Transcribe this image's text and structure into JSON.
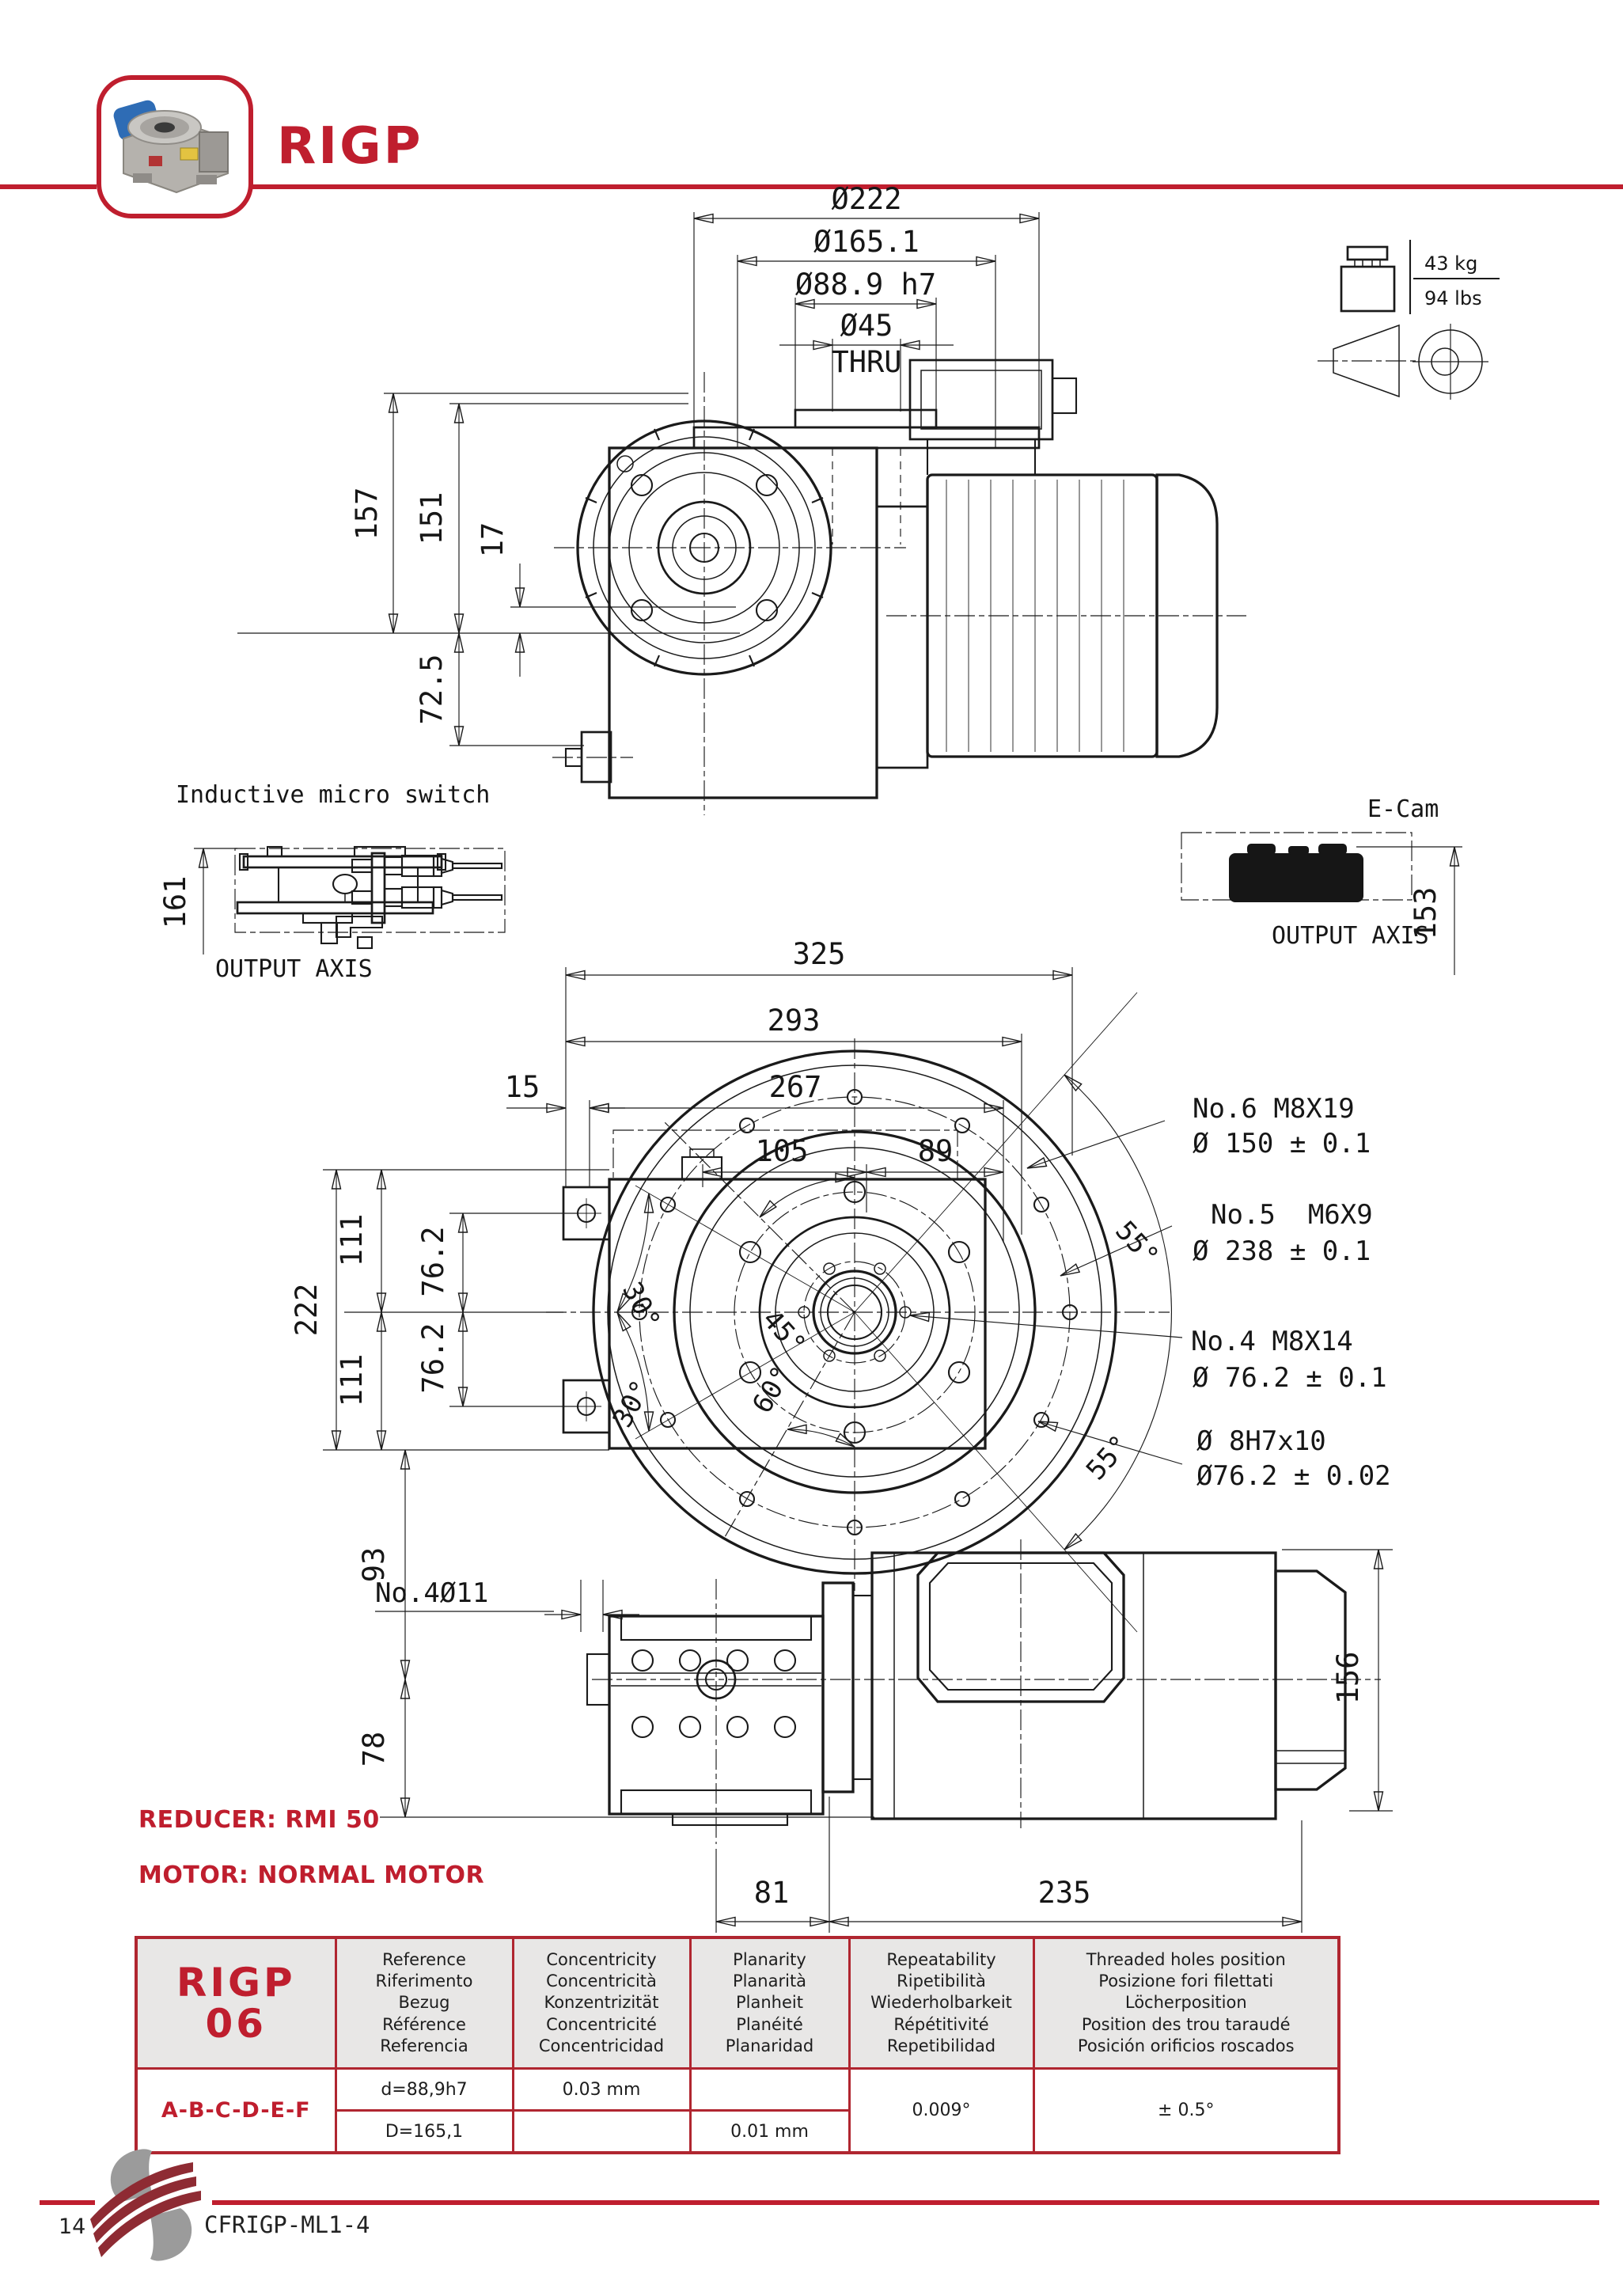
{
  "header": {
    "title": "RIGP"
  },
  "weight_badge": {
    "kg": "43 kg",
    "lbs": "94 lbs"
  },
  "top_view": {
    "dia222": "Ø222",
    "dia165": "Ø165.1",
    "dia889": "Ø88.9 h7",
    "dia45": "Ø45",
    "thru": "THRU",
    "d157": "157",
    "d151": "151",
    "d17": "17",
    "d725": "72.5"
  },
  "micro_switch": {
    "title": "Inductive micro switch",
    "d161": "161",
    "axis": "OUTPUT AXIS"
  },
  "ecam": {
    "title": "E-Cam",
    "d153": "153",
    "axis": "OUTPUT AXIS"
  },
  "front_view": {
    "d325": "325",
    "d293": "293",
    "d267": "267",
    "d15": "15",
    "d105": "105",
    "d89": "89",
    "d222": "222",
    "d111a": "111",
    "d111b": "111",
    "d762a": "76.2",
    "d762b": "76.2",
    "d93": "93",
    "d78": "78",
    "d81": "81",
    "d235": "235",
    "d156": "156",
    "no4d11": "No.4Ø11",
    "a55t": "55°",
    "a55b": "55°",
    "a30t": "30°",
    "a30b": "30°",
    "a45": "45°",
    "a60": "60°",
    "ann": [
      [
        "No.6 M8X19",
        "Ø 150 ± 0.1"
      ],
      [
        "No.5  M6X9",
        "Ø 238 ± 0.1"
      ],
      [
        "No.4 M8X14",
        "Ø 76.2 ± 0.1"
      ],
      [
        "Ø 8H7x10",
        "Ø76.2 ± 0.02"
      ]
    ]
  },
  "notes": {
    "reducer": "REDUCER: RMI 50",
    "motor": "MOTOR: NORMAL MOTOR"
  },
  "table": {
    "model_line1": "RIGP",
    "model_line2": "06",
    "row_label": "A-B-C-D-E-F",
    "headers": {
      "reference": [
        "Reference",
        "Riferimento",
        "Bezug",
        "Référence",
        "Referencia"
      ],
      "concentricity": [
        "Concentricity",
        "Concentricità",
        "Konzentrizität",
        "Concentricité",
        "Concentricidad"
      ],
      "planarity": [
        "Planarity",
        "Planarità",
        "Planheit",
        "Planéité",
        "Planaridad"
      ],
      "repeatability": [
        "Repeatability",
        "Ripetibilità",
        "Wiederholbarkeit",
        "Répétitivité",
        "Repetibilidad"
      ],
      "threaded": [
        "Threaded holes position",
        "Posizione fori filettati",
        "Löcherposition",
        "Position des trou taraudé",
        "Posición orificios roscados"
      ]
    },
    "rows": [
      {
        "reference": "d=88,9h7",
        "concentricity": "0.03 mm",
        "planarity": ""
      },
      {
        "reference": "D=165,1",
        "concentricity": "",
        "planarity": "0.01 mm"
      }
    ],
    "repeatability_value": "0.009°",
    "threaded_value": "± 0.5°"
  },
  "footer": {
    "page_number": "14",
    "code": "CFRIGP-ML1-4"
  }
}
